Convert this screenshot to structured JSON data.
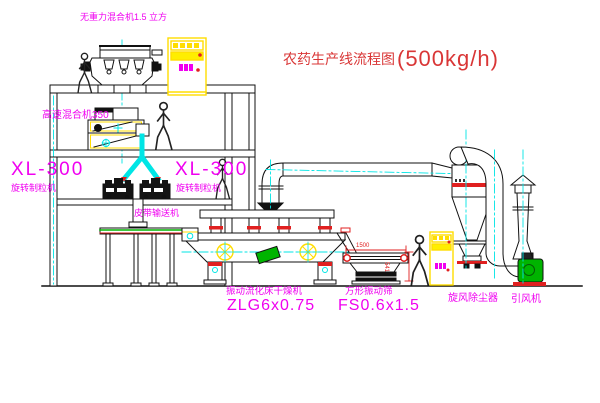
{
  "title": {
    "zh": "农药生产线流程图",
    "capacity": "(500kg/h)"
  },
  "labels": {
    "gravity_mixer": "无重力混合机1.5 立方",
    "high_speed_mixer": "高速混合机350",
    "granulator_model_1": "XL-300",
    "granulator_name_1": "旋转制粒机",
    "granulator_model_2": "XL-300",
    "granulator_name_2": "旋转制粒机",
    "belt_conveyor": "皮带输送机",
    "dryer_name": "振动流化床干燥机",
    "dryer_model": "ZLG6x0.75",
    "sieve_name": "方形振动筛",
    "sieve_model": "FS0.6x1.5",
    "dust_collector": "旋风除尘器",
    "draft_fan": "引风机"
  },
  "dimensions": {
    "sieve_length": "1500",
    "sieve_height": "541"
  },
  "colors": {
    "line": "#111111",
    "label_magenta": "#f000f0",
    "title_red": "#d93636",
    "accent_red": "#e02020",
    "accent_yellow": "#ffdd00",
    "accent_cyan": "#00e5e5",
    "accent_green": "#00b400"
  }
}
